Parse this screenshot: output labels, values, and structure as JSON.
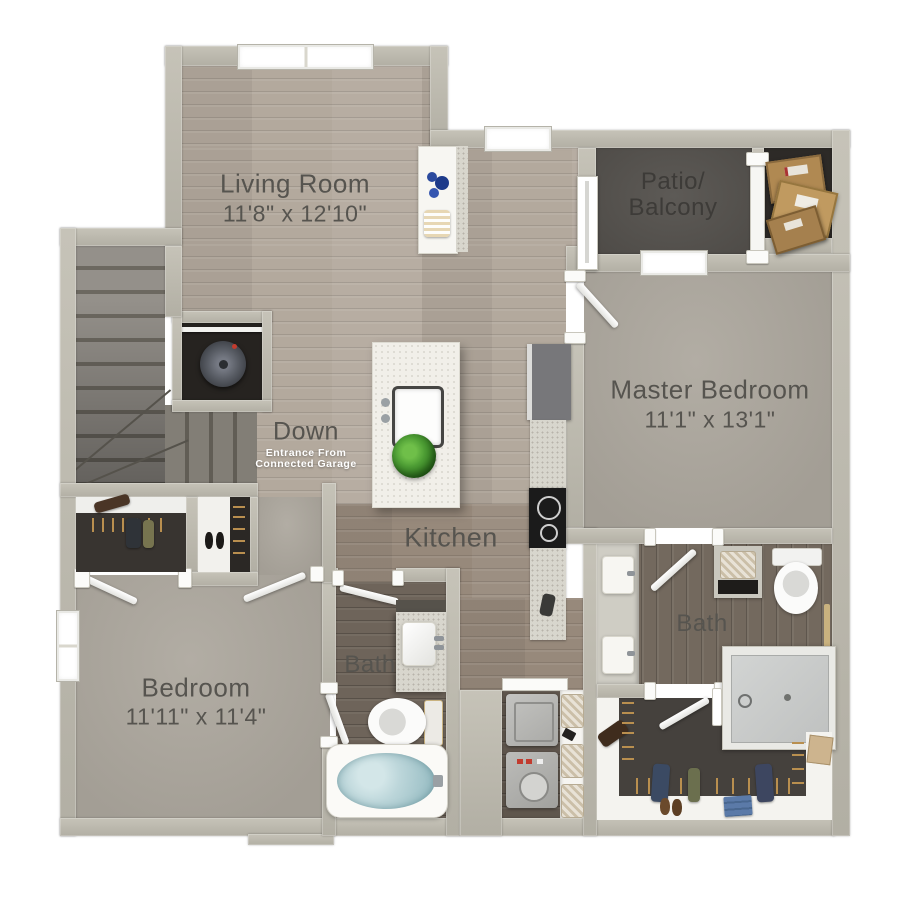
{
  "plan": {
    "type": "apartment-floor-plan",
    "rooms": {
      "living": {
        "name": "Living Room",
        "dims": "11'8\" x 12'10\""
      },
      "patio": {
        "line1": "Patio/",
        "line2": "Balcony"
      },
      "master": {
        "name": "Master Bedroom",
        "dims": "11'1\" x 13'1\""
      },
      "kitchen": {
        "name": "Kitchen"
      },
      "bedroom": {
        "name": "Bedroom",
        "dims": "11'11\" x 11'4\""
      },
      "bath": {
        "name": "Bath"
      },
      "master_bath": {
        "name": "Bath"
      },
      "stairs": {
        "label": "Down",
        "note1": "Entrance From",
        "note2": "Connected Garage"
      }
    },
    "palette": {
      "wall": "#b8b5aa",
      "wood": "#b3a99d",
      "wood_dark": "#6e645a",
      "carpet": "#a8a39a",
      "patio_floor": "#55524e",
      "closet_floor": "#45413d",
      "tub_water": "#bcd6da",
      "plant": "#4e9e35",
      "box_cardboard": "#b08952",
      "label_text": "#56544f"
    }
  }
}
